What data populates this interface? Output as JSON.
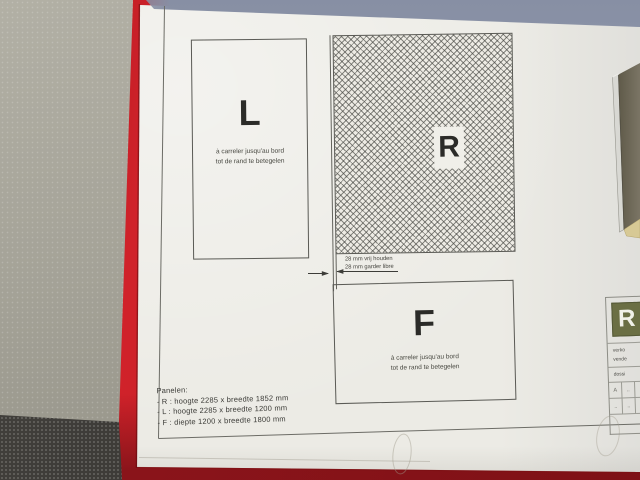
{
  "panels": {
    "l": {
      "label": "L",
      "note_line1": "à carreler jusqu'au bord",
      "note_line2": "tot de rand te betegelen"
    },
    "r": {
      "label": "R"
    },
    "f": {
      "label": "F",
      "note_line1": "à carreler jusqu'au bord",
      "note_line2": "tot de rand te betegelen"
    }
  },
  "dimension_note": {
    "line1": "28 mm vrij houden",
    "line2": "28 mm garder libre"
  },
  "legend": {
    "title": "Panelen:",
    "items": [
      "- R : hoogte 2285 x breedte 1852 mm",
      "- L : hoogte 2285 x breedte 1200 mm",
      "- F : diepte 1200 x breedte 1800 mm"
    ]
  },
  "title_block": {
    "logo_letter": "R",
    "seller_line1": "verko",
    "seller_line2": "vende",
    "dossier_label": "dossi",
    "table": [
      [
        "A",
        ".."
      ],
      [
        "..",
        ".."
      ]
    ]
  },
  "colors": {
    "folder_red": "#c92025",
    "desk_surface": "#a6a499",
    "carpet": "#403e3b",
    "paper": "#ecebe5",
    "top_shadow_band": "#939bae",
    "logo_green": "#6b6f44",
    "hatch_line": "#55554f",
    "panel_3d_face": "#6f6a58",
    "panel_3d_frame": "#d8d8d3",
    "panel_3d_floor": "#d7c995"
  }
}
